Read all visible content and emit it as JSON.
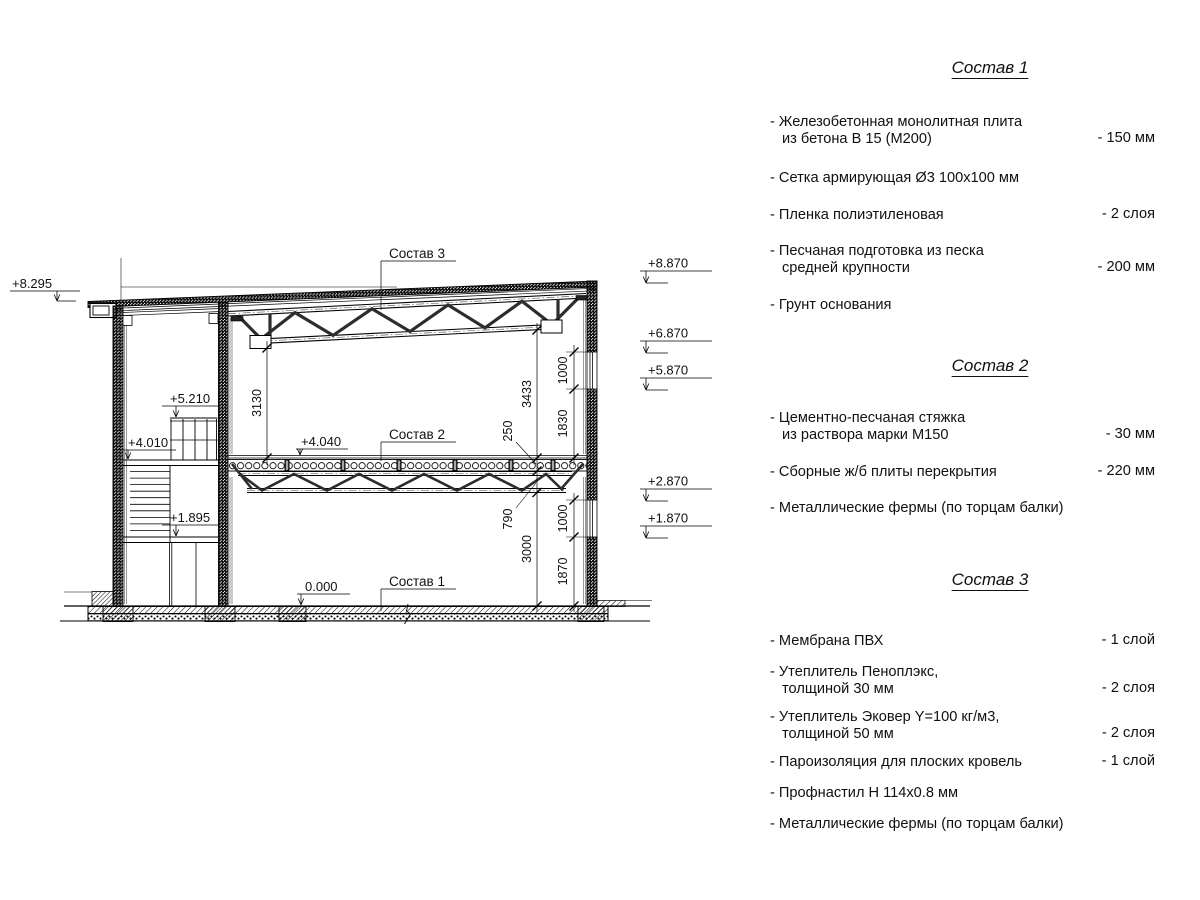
{
  "drawing": {
    "callouts": {
      "c1": "Состав 1",
      "c2": "Состав 2",
      "c3": "Состав 3"
    },
    "marks": {
      "m8295": "+8.295",
      "m8870": "+8.870",
      "m6870": "+6.870",
      "m5870": "+5.870",
      "m2870": "+2.870",
      "m1870": "+1.870",
      "m5210": "+5.210",
      "m4010": "+4.010",
      "m4040": "+4.040",
      "m1895": "+1.895",
      "m0000": "0.000"
    },
    "dims": {
      "d3130": "3130",
      "d3433": "3433",
      "d250": "250",
      "d1000u": "1000",
      "d1830": "1830",
      "d790": "790",
      "d3000": "3000",
      "d1000l": "1000",
      "d1870": "1870"
    }
  },
  "panel": {
    "sections": [
      {
        "title": "Состав 1",
        "items": [
          {
            "lines": [
              "- Железобетонная  монолитная плита",
              "из бетона В 15 (М200)"
            ],
            "value": "- 150 мм"
          },
          {
            "lines": [
              "- Сетка армирующая Ø3 100х100 мм"
            ],
            "value": ""
          },
          {
            "lines": [
              "- Пленка полиэтиленовая"
            ],
            "value": "-  2 слоя"
          },
          {
            "lines": [
              "- Песчаная подготовка из песка",
              "средней крупности"
            ],
            "value": "- 200 мм"
          },
          {
            "lines": [
              "- Грунт основания"
            ],
            "value": ""
          }
        ]
      },
      {
        "title": "Состав 2",
        "items": [
          {
            "lines": [
              "- Цементно-песчаная стяжка",
              "из раствора марки М150"
            ],
            "value": "- 30 мм"
          },
          {
            "lines": [
              "- Сборные ж/б плиты перекрытия"
            ],
            "value": "- 220 мм"
          },
          {
            "lines": [
              "- Металлические фермы (по торцам балки)"
            ],
            "value": ""
          }
        ]
      },
      {
        "title": "Состав 3",
        "items": [
          {
            "lines": [
              "- Мембрана ПВХ"
            ],
            "value": "- 1 слой"
          },
          {
            "lines": [
              "- Утеплитель Пеноплэкс,",
              "толщиной 30 мм"
            ],
            "value": "- 2 слоя"
          },
          {
            "lines": [
              "- Утеплитель Эковер Y=100 кг/м3,",
              "толщиной 50 мм"
            ],
            "value": "- 2 слоя"
          },
          {
            "lines": [
              "- Пароизоляция для плоских кровель"
            ],
            "value": "- 1 слой"
          },
          {
            "lines": [
              "- Профнастил Н 114х0.8 мм"
            ],
            "value": ""
          },
          {
            "lines": [
              "- Металлические фермы (по торцам балки)"
            ],
            "value": ""
          }
        ]
      }
    ]
  }
}
